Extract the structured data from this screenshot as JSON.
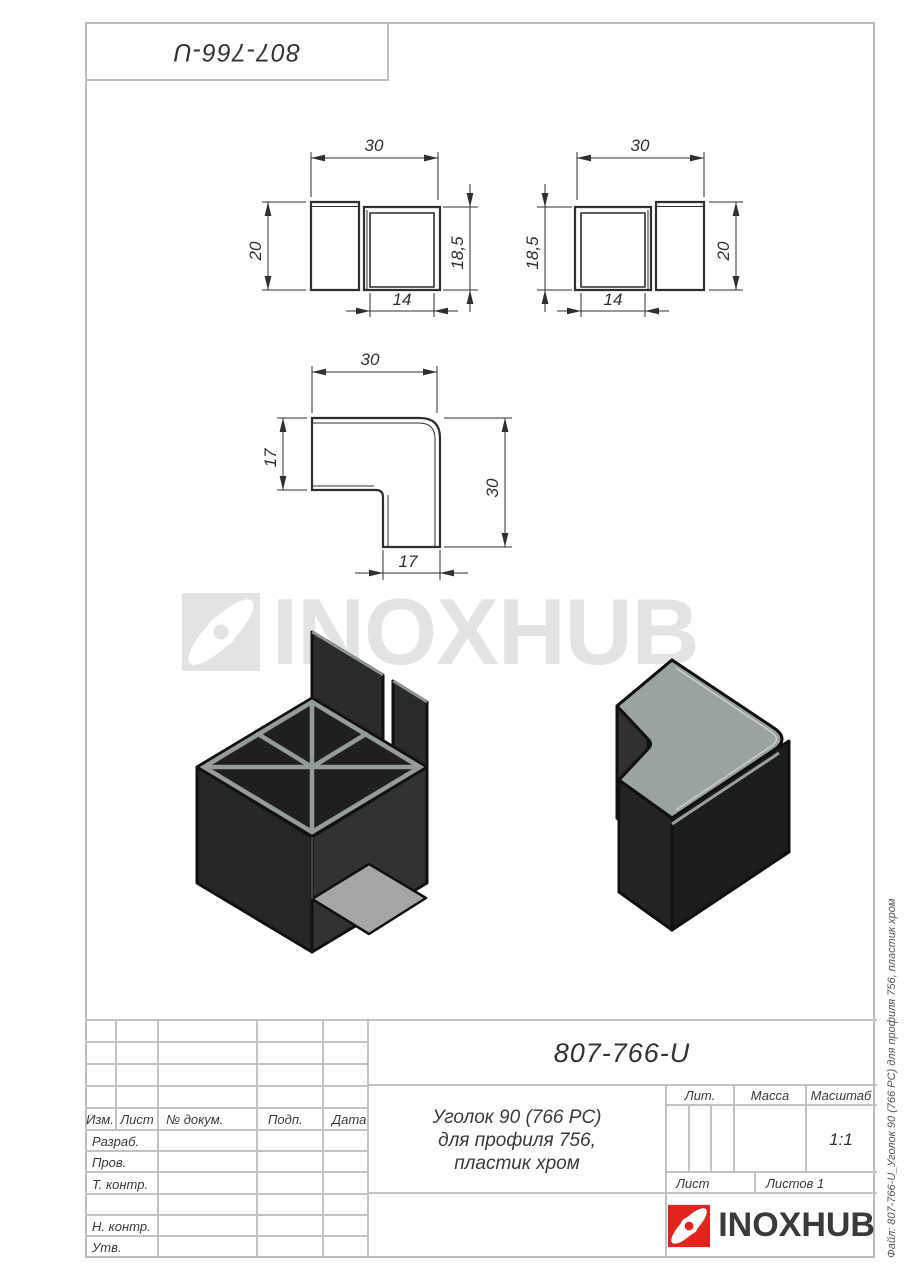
{
  "drawing": {
    "part_number": "807-766-U",
    "file_label": "Файл: 807-766-U_Уголок 90 (766 РС) для профиля 756, пластик хром",
    "watermark_text": "INOXHUB"
  },
  "views": {
    "front_left": {
      "top": "30",
      "left": "20",
      "right": "18,5",
      "bottom": "14"
    },
    "front_right": {
      "top": "30",
      "left": "18,5",
      "right": "20",
      "bottom": "14"
    },
    "plan": {
      "top": "30",
      "left": "17",
      "right": "30",
      "bottom": "17"
    }
  },
  "title_block": {
    "doc_number": "807-766-U",
    "description_line1": "Уголок 90 (766 РС)",
    "description_line2": "для профиля 756,",
    "description_line3": "пластик хром",
    "col_izm": "Изм.",
    "col_list": "Лист",
    "col_doc": "№ докум.",
    "col_podp": "Подп.",
    "col_data": "Дата",
    "row_razrab": "Разраб.",
    "row_prov": "Пров.",
    "row_tkontr": "Т. контр.",
    "row_nkontr": "Н. контр.",
    "row_utv": "Утв.",
    "lit_label": "Лит.",
    "massa_label": "Масса",
    "masshtab_label": "Масштаб",
    "scale_value": "1:1",
    "list_label": "Лист",
    "listov_label": "Листов 1",
    "brand_text": "INOXHUB"
  },
  "colors": {
    "brand_red": "#e2231e",
    "line_gray": "#c3c3c3",
    "ink": "#2f2f2f",
    "watermark": "#e3e3e3"
  }
}
